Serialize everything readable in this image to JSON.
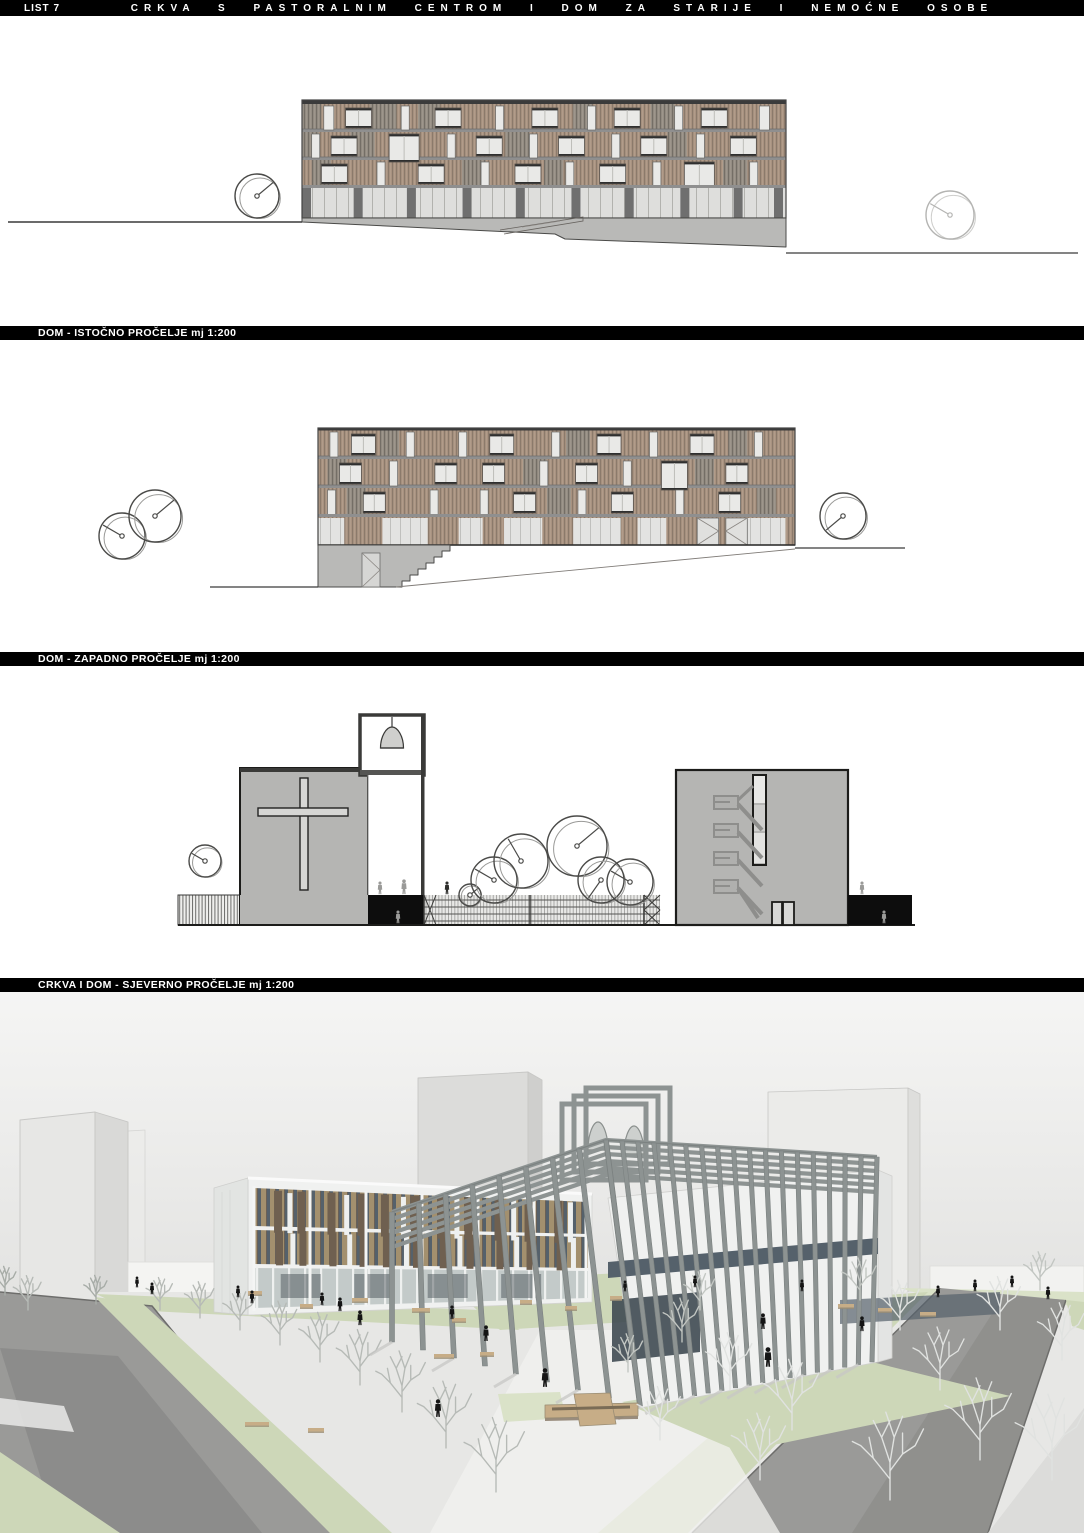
{
  "header": {
    "sheet": "LIST 7",
    "title": "CRKVA S PASTORALNIM CENTROM I DOM ZA STARIJE I NEMOĆNE OSOBE"
  },
  "sections": [
    {
      "label": "DOM - ISTOČNO PROČELJE mj 1:200"
    },
    {
      "label": "DOM - ZAPADNO PROČELJE mj 1:200"
    },
    {
      "label": "CRKVA I DOM - SJEVERNO PROČELJE mj 1:200"
    }
  ],
  "palette": {
    "bar_bg": "#000000",
    "bar_text": "#ffffff",
    "paper": "#ffffff",
    "line": "#2e2e2e",
    "slat_brown": "#a89280",
    "slat_brown_dark": "#8b7a6b",
    "slat_gray": "#948d83",
    "slat_gray_dark": "#746e66",
    "window": "#e9e9e7",
    "frame": "#2f2f2f",
    "band": "#8f8f8f",
    "glazing": "#dededc",
    "mullion": "#b2b2ae",
    "pier": "#6f6f6f",
    "ground": "#b9b9b7",
    "ground_line": "#3a3a3a",
    "church_gray": "#b5b5b3",
    "black": "#0d0d0d",
    "stair": "#8e8e8c",
    "sky_top": "#f5f5f4",
    "sky_bottom": "#d5d5d3",
    "ghost": "#e7e7e5",
    "ghost_side": "#d9d9d7",
    "ghost_edge": "#c7c7c5",
    "plaza": "#e7e7e5",
    "walkway": "#f1f1ef",
    "road": "#9a9a98",
    "road_dark": "#8b8b89",
    "curb": "#6d6d6b",
    "sidewalk": "#dcdcda",
    "lawn": "#cdd7b8",
    "lawn_light": "#dae2c8",
    "pergola": "#8d9392",
    "glass": "#55616b",
    "glass_dark": "#3f4a52",
    "fin": "#a3906e",
    "fin_dark": "#6f6050",
    "white_bldg": "#f0f1f0",
    "white_bldg_side": "#e2e4e2",
    "bench": "#c7ad87",
    "bench_dark": "#7a6c56",
    "tree_fg": "#e0e2e0",
    "tree_mid": "#c2c6c2",
    "tree_bg": "#a7aca7",
    "person": "#151515",
    "person_gray": "#9a9a98",
    "track": "#b97a6d"
  },
  "elevation_east": {
    "windows": [
      [
        0,
        0.045,
        10,
        1
      ],
      [
        0,
        0.09,
        26,
        0
      ],
      [
        0,
        0.205,
        8,
        1
      ],
      [
        0,
        0.275,
        26,
        0
      ],
      [
        0,
        0.4,
        8,
        1
      ],
      [
        0,
        0.475,
        26,
        0
      ],
      [
        0,
        0.59,
        8,
        1
      ],
      [
        0,
        0.645,
        26,
        0
      ],
      [
        0,
        0.77,
        8,
        1
      ],
      [
        0,
        0.825,
        26,
        0
      ],
      [
        0,
        0.945,
        10,
        1
      ],
      [
        1,
        0.02,
        8,
        1
      ],
      [
        1,
        0.06,
        26,
        0
      ],
      [
        1,
        0.18,
        30,
        2
      ],
      [
        1,
        0.3,
        8,
        1
      ],
      [
        1,
        0.36,
        26,
        0
      ],
      [
        1,
        0.47,
        8,
        1
      ],
      [
        1,
        0.53,
        26,
        0
      ],
      [
        1,
        0.64,
        8,
        1
      ],
      [
        1,
        0.7,
        26,
        0
      ],
      [
        1,
        0.815,
        8,
        1
      ],
      [
        1,
        0.885,
        26,
        0
      ],
      [
        2,
        0.04,
        26,
        0
      ],
      [
        2,
        0.155,
        8,
        1
      ],
      [
        2,
        0.24,
        26,
        0
      ],
      [
        2,
        0.37,
        8,
        1
      ],
      [
        2,
        0.44,
        26,
        0
      ],
      [
        2,
        0.545,
        8,
        1
      ],
      [
        2,
        0.615,
        26,
        0
      ],
      [
        2,
        0.725,
        8,
        1
      ],
      [
        2,
        0.79,
        30,
        2
      ],
      [
        2,
        0.925,
        8,
        1
      ]
    ],
    "gray_patches": [
      [
        0,
        0.0,
        0.04
      ],
      [
        0,
        0.14,
        0.055
      ],
      [
        0,
        0.24,
        0.045
      ],
      [
        0,
        0.56,
        0.04
      ],
      [
        0,
        0.72,
        0.05
      ],
      [
        1,
        0.0,
        0.035
      ],
      [
        1,
        0.1,
        0.05
      ],
      [
        1,
        0.42,
        0.05
      ],
      [
        1,
        0.755,
        0.04
      ],
      [
        2,
        0.02,
        0.04
      ],
      [
        2,
        0.33,
        0.05
      ],
      [
        2,
        0.5,
        0.04
      ],
      [
        2,
        0.87,
        0.05
      ]
    ],
    "piers": [
      0,
      0.115,
      0.225,
      0.34,
      0.45,
      0.565,
      0.675,
      0.79,
      0.9,
      0.985
    ],
    "trees": [
      [
        257,
        196,
        22,
        0
      ],
      [
        950,
        215,
        24,
        1
      ]
    ]
  },
  "elevation_west": {
    "windows": [
      [
        0,
        0.025,
        8,
        1
      ],
      [
        0,
        0.07,
        24,
        0
      ],
      [
        0,
        0.185,
        8,
        1
      ],
      [
        0,
        0.295,
        8,
        1
      ],
      [
        0,
        0.36,
        24,
        0
      ],
      [
        0,
        0.49,
        8,
        1
      ],
      [
        0,
        0.585,
        24,
        0
      ],
      [
        0,
        0.695,
        8,
        1
      ],
      [
        0,
        0.78,
        24,
        0
      ],
      [
        0,
        0.915,
        8,
        1
      ],
      [
        1,
        0.045,
        22,
        0
      ],
      [
        1,
        0.15,
        8,
        1
      ],
      [
        1,
        0.245,
        22,
        0
      ],
      [
        1,
        0.345,
        22,
        0
      ],
      [
        1,
        0.465,
        8,
        1
      ],
      [
        1,
        0.54,
        22,
        0
      ],
      [
        1,
        0.64,
        8,
        1
      ],
      [
        1,
        0.72,
        26,
        2
      ],
      [
        1,
        0.855,
        22,
        0
      ],
      [
        2,
        0.02,
        8,
        1
      ],
      [
        2,
        0.095,
        22,
        0
      ],
      [
        2,
        0.235,
        8,
        1
      ],
      [
        2,
        0.34,
        8,
        1
      ],
      [
        2,
        0.41,
        22,
        0
      ],
      [
        2,
        0.545,
        8,
        1
      ],
      [
        2,
        0.615,
        22,
        0
      ],
      [
        2,
        0.75,
        8,
        1
      ],
      [
        2,
        0.84,
        22,
        0
      ]
    ],
    "gray_patches": [
      [
        0,
        0.13,
        0.04
      ],
      [
        0,
        0.52,
        0.05
      ],
      [
        0,
        0.86,
        0.04
      ],
      [
        1,
        0.02,
        0.04
      ],
      [
        1,
        0.43,
        0.05
      ],
      [
        1,
        0.79,
        0.04
      ],
      [
        2,
        0.06,
        0.04
      ],
      [
        2,
        0.48,
        0.05
      ],
      [
        2,
        0.92,
        0.04
      ]
    ],
    "panels": [
      [
        0,
        0.055
      ],
      [
        0.135,
        0.095
      ],
      [
        0.295,
        0.05
      ],
      [
        0.39,
        0.08
      ],
      [
        0.535,
        0.1
      ],
      [
        0.67,
        0.06
      ],
      [
        0.9,
        0.08
      ]
    ],
    "doors": [
      0.795,
      0.855
    ],
    "trees": [
      [
        122,
        536,
        23,
        2
      ],
      [
        155,
        516,
        26,
        0
      ],
      [
        843,
        516,
        23,
        3
      ]
    ]
  },
  "elevation_north": {
    "trees": [
      [
        205,
        861,
        16,
        2
      ],
      [
        470,
        895,
        11,
        0
      ],
      [
        494,
        880,
        23,
        2
      ],
      [
        521,
        861,
        27,
        4
      ],
      [
        577,
        846,
        30,
        0
      ],
      [
        601,
        880,
        23,
        5
      ],
      [
        630,
        882,
        23,
        2
      ]
    ],
    "figures": [
      [
        380,
        895,
        13,
        "g"
      ],
      [
        404,
        895,
        15,
        "g"
      ],
      [
        398,
        924,
        13,
        "g"
      ],
      [
        447,
        895,
        13,
        "d"
      ],
      [
        862,
        895,
        13,
        "g"
      ],
      [
        884,
        924,
        13,
        "g"
      ]
    ]
  },
  "render": {
    "fins_dark": [
      0.06,
      0.13,
      0.22,
      0.31,
      0.38,
      0.47,
      0.55,
      0.63,
      0.72,
      0.81,
      0.9
    ],
    "fins_light": [
      0.1,
      0.27,
      0.44,
      0.6,
      0.77,
      0.94
    ],
    "trees_bg": [
      [
        160,
        1310,
        34
      ],
      [
        200,
        1318,
        38
      ],
      [
        240,
        1330,
        42
      ],
      [
        280,
        1345,
        46
      ],
      [
        320,
        1362,
        52
      ],
      [
        360,
        1385,
        58
      ],
      [
        402,
        1412,
        64
      ],
      [
        446,
        1448,
        70
      ],
      [
        496,
        1492,
        78
      ],
      [
        28,
        1310,
        36
      ],
      [
        5,
        1295,
        30
      ],
      [
        96,
        1304,
        30
      ]
    ],
    "trees_fg": [
      [
        700,
        1310,
        40
      ],
      [
        682,
        1342,
        46
      ],
      [
        730,
        1390,
        60
      ],
      [
        792,
        1430,
        74
      ],
      [
        860,
        1300,
        44
      ],
      [
        900,
        1330,
        52
      ],
      [
        940,
        1390,
        66
      ],
      [
        1000,
        1330,
        56
      ],
      [
        1040,
        1290,
        40
      ],
      [
        1062,
        1360,
        60
      ],
      [
        980,
        1460,
        86
      ],
      [
        890,
        1500,
        92
      ],
      [
        1052,
        1480,
        90
      ],
      [
        760,
        1480,
        70
      ],
      [
        660,
        1440,
        56
      ],
      [
        628,
        1372,
        40
      ]
    ],
    "people": [
      [
        137,
        1288,
        11
      ],
      [
        152,
        1295,
        12
      ],
      [
        238,
        1298,
        12
      ],
      [
        252,
        1304,
        13
      ],
      [
        322,
        1306,
        13
      ],
      [
        340,
        1312,
        14
      ],
      [
        360,
        1326,
        15
      ],
      [
        452,
        1320,
        14
      ],
      [
        486,
        1342,
        16
      ],
      [
        545,
        1388,
        19
      ],
      [
        438,
        1418,
        18
      ],
      [
        695,
        1288,
        12
      ],
      [
        802,
        1292,
        12
      ],
      [
        763,
        1330,
        16
      ],
      [
        768,
        1368,
        20
      ],
      [
        938,
        1298,
        12
      ],
      [
        975,
        1292,
        12
      ],
      [
        1012,
        1288,
        12
      ],
      [
        1048,
        1300,
        13
      ],
      [
        862,
        1332,
        15
      ],
      [
        625,
        1292,
        11
      ]
    ],
    "benches": [
      [
        248,
        1291,
        14
      ],
      [
        352,
        1298,
        16
      ],
      [
        300,
        1304,
        13
      ],
      [
        412,
        1308,
        18
      ],
      [
        452,
        1318,
        14
      ],
      [
        434,
        1354,
        20
      ],
      [
        480,
        1352,
        14
      ],
      [
        245,
        1422,
        24
      ],
      [
        308,
        1428,
        16
      ],
      [
        838,
        1304,
        16
      ],
      [
        878,
        1308,
        14
      ],
      [
        920,
        1312,
        16
      ],
      [
        520,
        1300,
        12
      ],
      [
        565,
        1306,
        12
      ],
      [
        610,
        1296,
        12
      ]
    ]
  }
}
